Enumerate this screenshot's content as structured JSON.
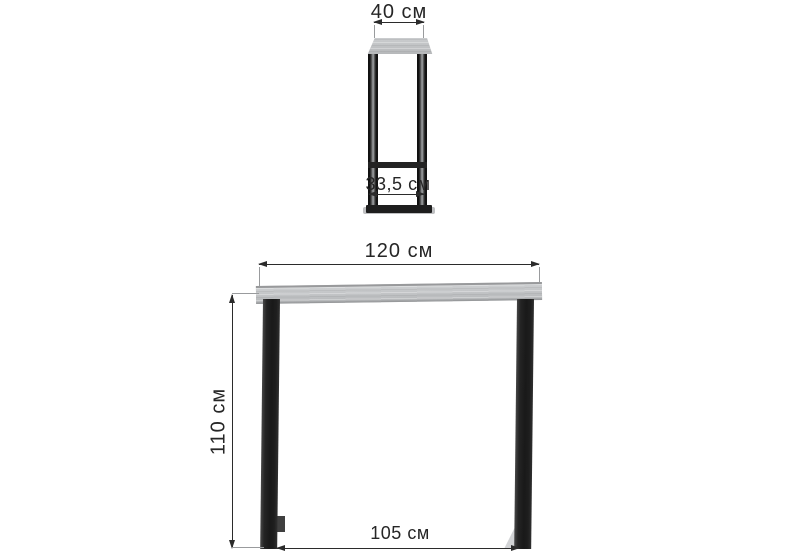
{
  "figure": {
    "side_view": {
      "top_width": {
        "label": "40 см"
      },
      "base_depth": {
        "label": "33,5 см"
      }
    },
    "front_view": {
      "top_width": {
        "label": "120 см"
      },
      "height": {
        "label": "110 см"
      },
      "base_width": {
        "label": "105 см"
      }
    },
    "colors": {
      "background": "#ffffff",
      "dimension_line": "#2b2b2b",
      "extension_line": "#999b9d",
      "tabletop": "#c3c5c7",
      "tabletop_edge": "#98999b",
      "metal_frame": "#1e1e1e"
    }
  }
}
